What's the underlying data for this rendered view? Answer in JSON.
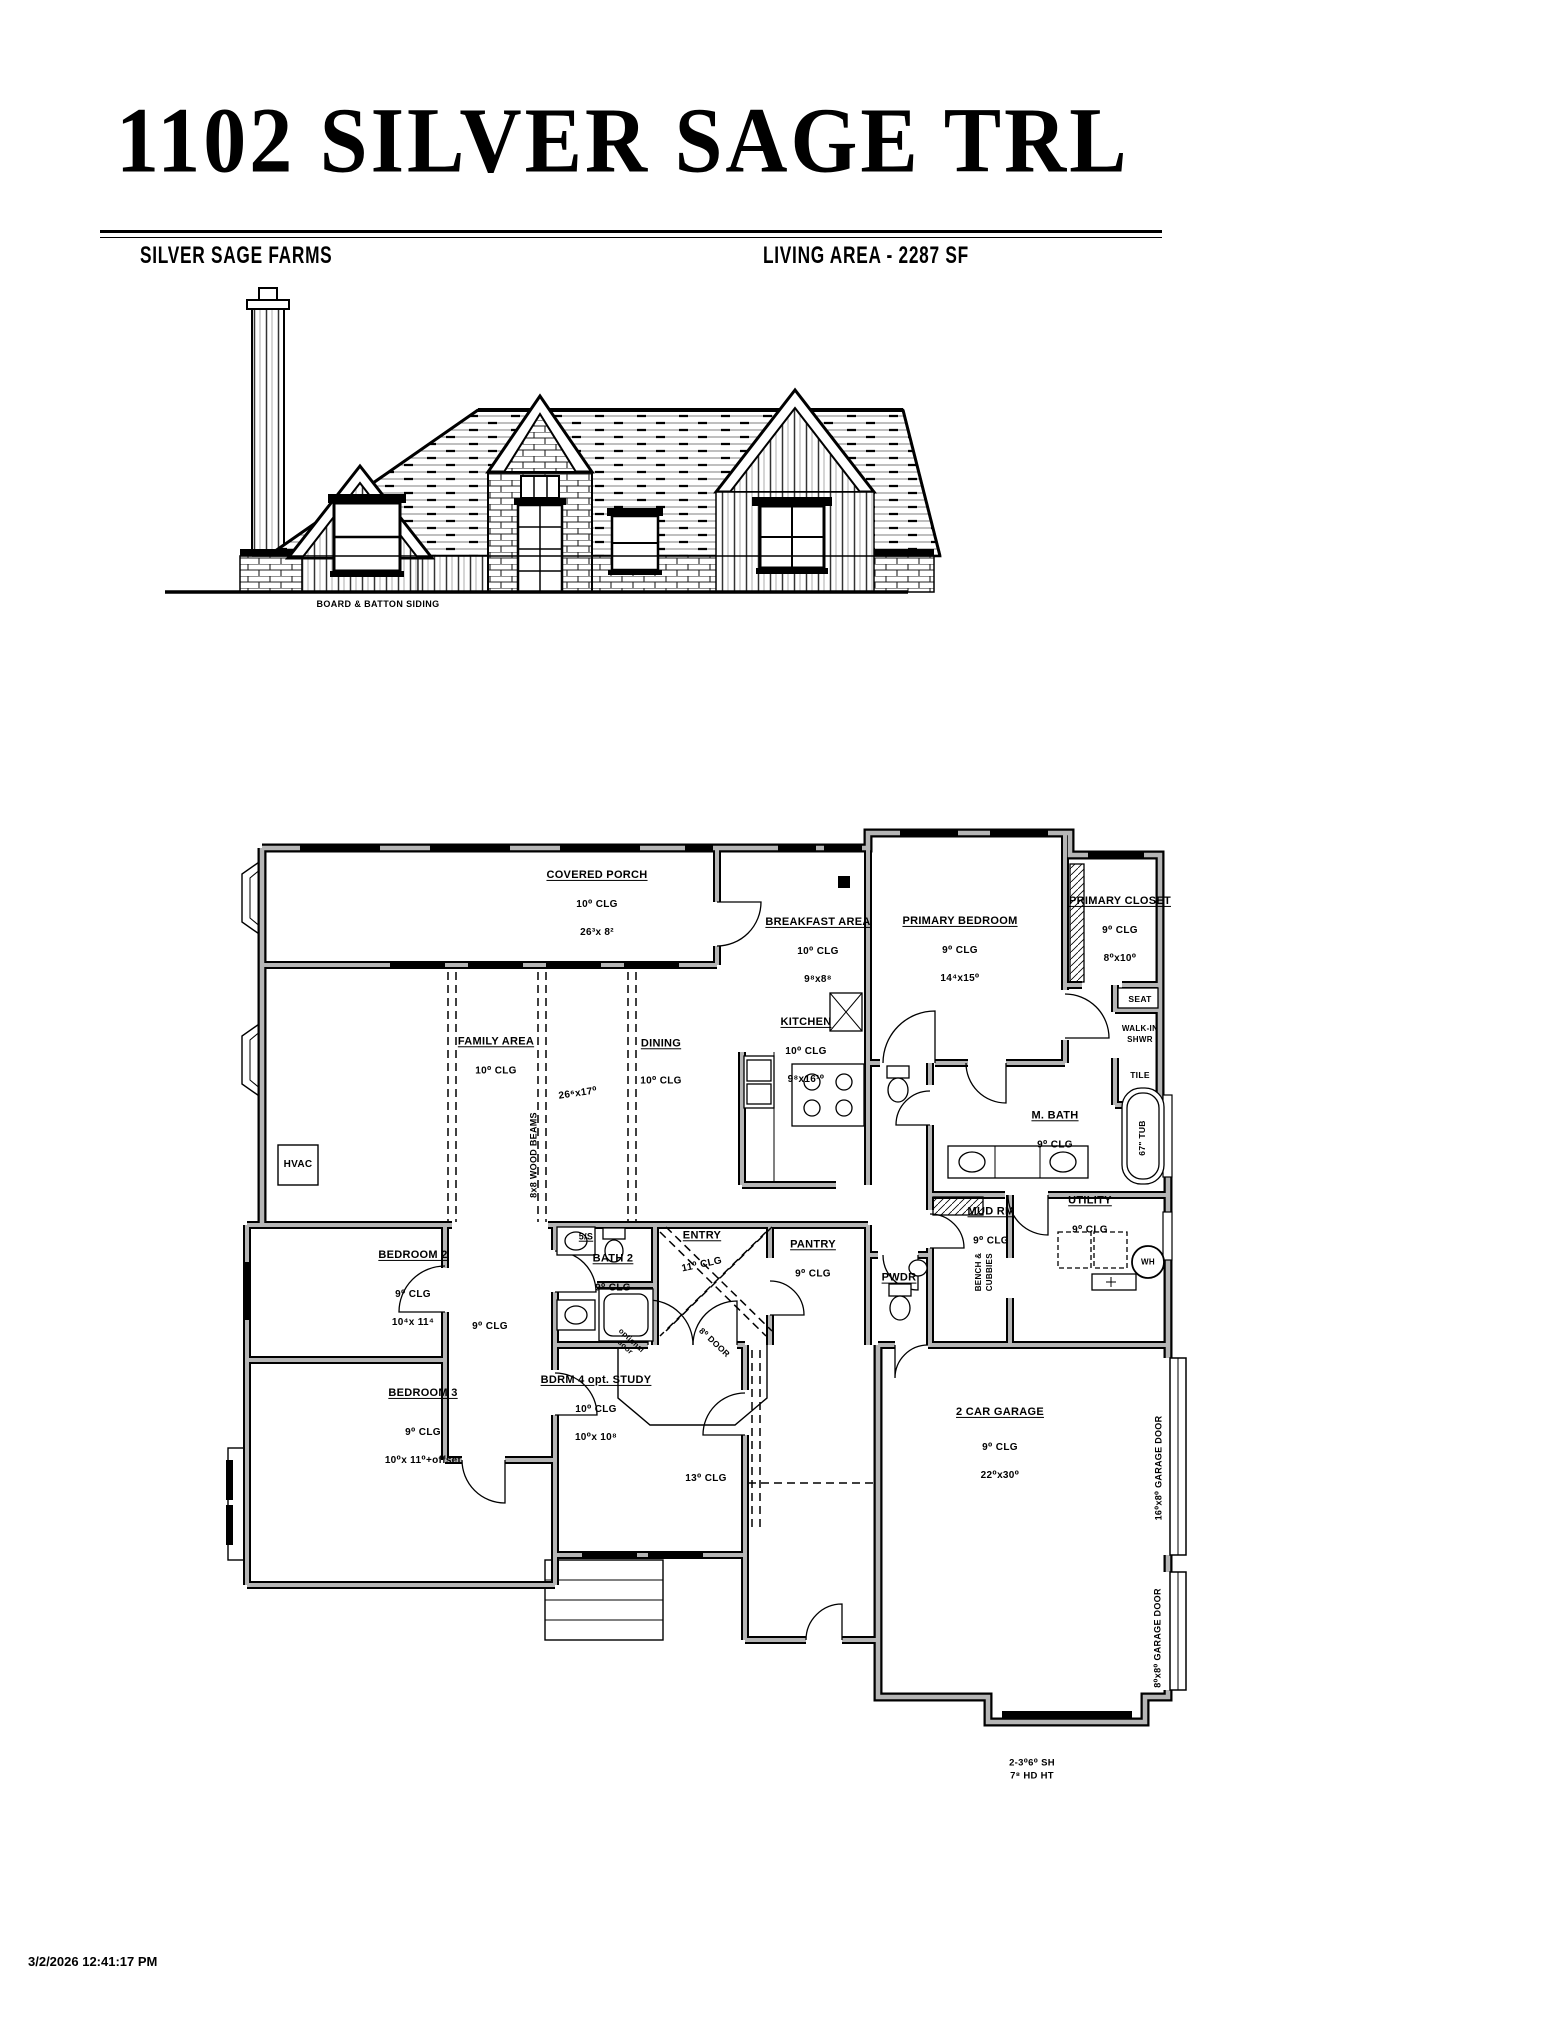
{
  "colors": {
    "ink": "#000000",
    "wall_gray": "#b5b5b5",
    "paper": "#ffffff"
  },
  "header": {
    "title": "1102 SILVER SAGE TRL",
    "subdivision": "SILVER SAGE FARMS",
    "living_area": "LIVING AREA - 2287 SF"
  },
  "elevation": {
    "siding_label": "BOARD & BATTON SIDING"
  },
  "plan": {
    "rooms": {
      "covered_porch": {
        "name": "COVERED PORCH",
        "clg": "10⁰ CLG",
        "dim": "26³x 8²"
      },
      "breakfast": {
        "name": "BREAKFAST AREA",
        "clg": "10⁰ CLG",
        "dim": "9⁸x8⁸"
      },
      "primary_bedroom": {
        "name": "PRIMARY BEDROOM",
        "clg": "9⁰ CLG",
        "dim": "14⁴x15⁰"
      },
      "primary_closet": {
        "name": "PRIMARY CLOSET",
        "clg": "9⁰ CLG",
        "dim": "8⁰x10⁰"
      },
      "family": {
        "name": "FAMILY AREA",
        "clg": "10⁰ CLG",
        "dim": "26⁶x17⁰"
      },
      "dining": {
        "name": "DINING",
        "clg": "10⁰ CLG"
      },
      "kitchen": {
        "name": "KITCHEN",
        "clg": "10⁰ CLG",
        "dim": "9⁸x16¹⁰"
      },
      "m_bath": {
        "name": "M. BATH",
        "clg": "9⁰ CLG"
      },
      "utility": {
        "name": "UTILITY",
        "clg": "9⁰ CLG"
      },
      "mud_rm": {
        "name": "MUD RM",
        "clg": "9⁰ CLG"
      },
      "pwdr": {
        "name": "PWDR"
      },
      "pantry": {
        "name": "PANTRY",
        "clg": "9⁰ CLG"
      },
      "entry": {
        "name": "ENTRY",
        "clg": "11⁰ CLG"
      },
      "bedroom2": {
        "name": "BEDROOM 2",
        "clg": "9⁰ CLG",
        "dim": "10⁴x 11⁴"
      },
      "bath2": {
        "name": "BATH 2",
        "clg": "9⁰ CLG"
      },
      "bedroom3": {
        "name": "BEDROOM 3",
        "clg": "9⁰ CLG",
        "dim": "10⁰x 11⁰+offset"
      },
      "bdrm4": {
        "name": "BDRM 4 opt. STUDY",
        "clg": "10⁰ CLG",
        "dim": "10⁰x 10⁸"
      },
      "garage": {
        "name": "2 CAR GARAGE",
        "clg": "9⁰ CLG",
        "dim": "22⁰x30⁰"
      }
    },
    "annotations": {
      "seat": "SEAT",
      "walk_in_shwr": "WALK-IN\nSHWR",
      "tile": "TILE",
      "tub": "67\" TUB",
      "wood_beams": "8x8 WOOD BEAMS",
      "bench_cubbies": "BENCH &\nCUBBIES",
      "shelves": "5/S",
      "hvac": "HVAC",
      "water_heater": "WH",
      "hall_clg": "9⁰ CLG",
      "hall13_clg": "13⁰ CLG",
      "entry_door": "8⁰ DOOR",
      "optional_door": "optional\ndoor",
      "garage_door_16": "16⁰x8⁰ GARAGE DOOR",
      "garage_door_8": "8⁰x8⁰ GARAGE DOOR",
      "garage_window": "2-3⁰6⁰ SH\n7⁸ HD HT"
    }
  },
  "footer": {
    "timestamp": "3/2/2026 12:41:17 PM"
  }
}
